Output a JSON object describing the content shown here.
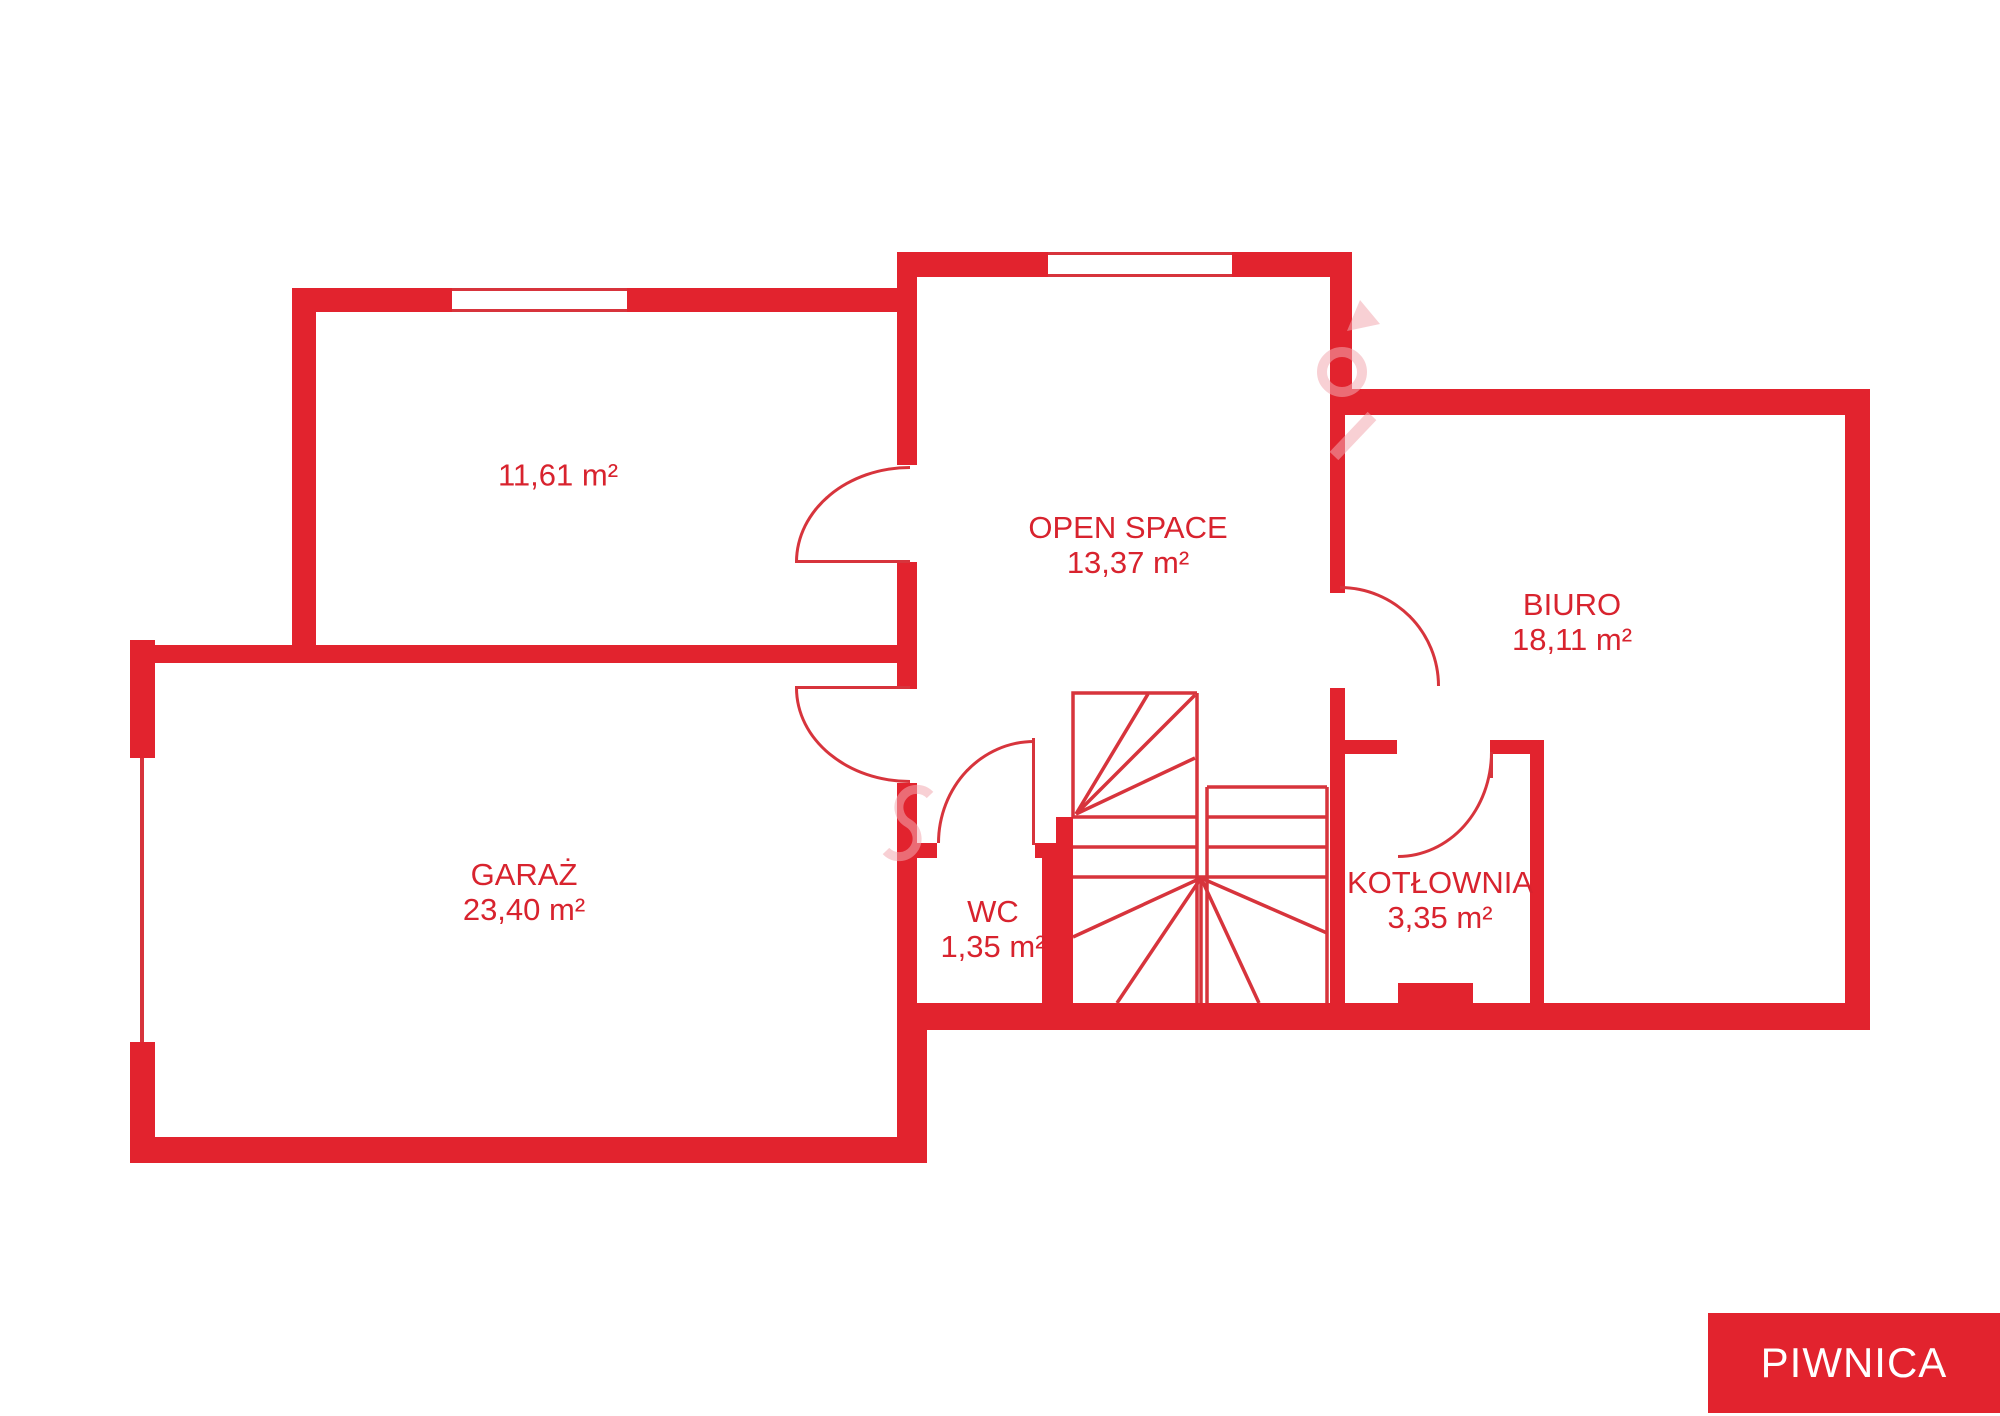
{
  "plan": {
    "type": "floor-plan",
    "floor_badge": "PIWNICA",
    "rooms": [
      {
        "id": "room-a",
        "name": "",
        "area": "11,61 m²"
      },
      {
        "id": "open-space",
        "name": "OPEN SPACE",
        "area": "13,37 m²"
      },
      {
        "id": "biuro",
        "name": "BIURO",
        "area": "18,11 m²"
      },
      {
        "id": "garaz",
        "name": "GARAŻ",
        "area": "23,40 m²"
      },
      {
        "id": "wc",
        "name": "WC",
        "area": "1,35 m²"
      },
      {
        "id": "kotlownia",
        "name": "KOTŁOWNIA",
        "area": "3,35 m²"
      }
    ],
    "colors": {
      "wall": "#e2232e",
      "thin_line": "#d7343c",
      "label_text": "#d8232e",
      "watermark": "#f3aab0",
      "badge_background": "#e2232e",
      "badge_text": "#ffffff"
    }
  }
}
